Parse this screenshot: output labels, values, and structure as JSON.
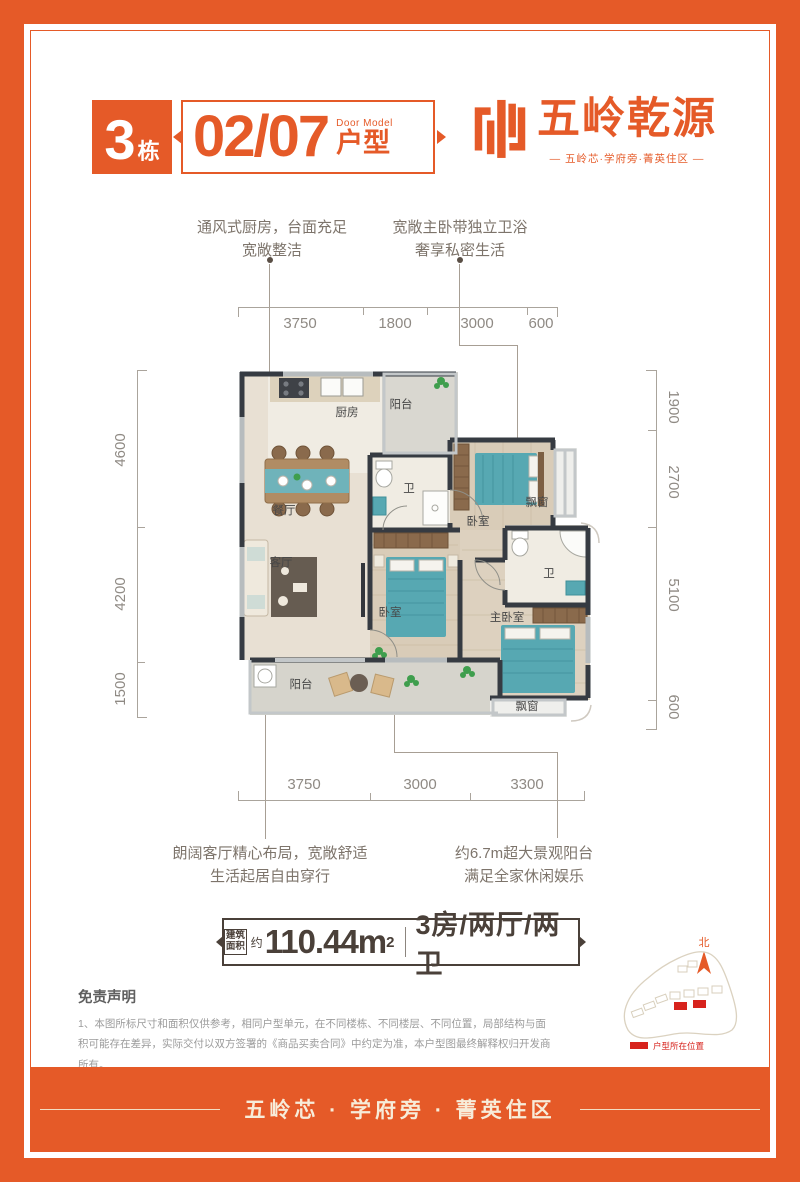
{
  "colors": {
    "accent": "#e55a28",
    "legend_red": "#d7231d"
  },
  "header": {
    "building_num": "3",
    "building_suffix": "栋",
    "unit_code": "02/07",
    "door_model_en": "Door Model",
    "door_model_cn": "户型",
    "brand_name": "五岭乾源",
    "brand_tagline": "— 五岭芯·学府旁·菁英住区 —"
  },
  "callouts": {
    "kitchen": {
      "line1": "通风式厨房，台面充足",
      "line2": "宽敞整洁"
    },
    "master": {
      "line1": "宽敞主卧带独立卫浴",
      "line2": "奢享私密生活"
    },
    "living": {
      "line1": "朗阔客厅精心布局，宽敞舒适",
      "line2": "生活起居自由穿行"
    },
    "balcony": {
      "line1": "约6.7m超大景观阳台",
      "line2": "满足全家休闲娱乐"
    }
  },
  "dimensions": {
    "top": [
      "3750",
      "1800",
      "3000",
      "600"
    ],
    "bottom": [
      "3750",
      "3000",
      "3300"
    ],
    "left": [
      "4600",
      "4200",
      "1500"
    ],
    "right": [
      "1900",
      "2700",
      "5100",
      "600"
    ]
  },
  "rooms": {
    "kitchen": "厨房",
    "balcony_top": "阳台",
    "bath_top": "卫",
    "bedroom_top": "卧室",
    "bay_right": "飘窗",
    "dining": "餐厅",
    "living": "客厅",
    "bedroom_mid": "卧室",
    "master": "主卧室",
    "bath_master": "卫",
    "balcony_bottom": "阳台",
    "bay_bottom": "飘窗"
  },
  "area": {
    "label": "建筑面积",
    "approx": "约",
    "value": "110.44m",
    "sup": "2",
    "layout": "3房/两厅/两卫"
  },
  "disclaimer": {
    "title": "免责声明",
    "line1": "1、本图所标尺寸和面积仅供参考，相同户型单元，在不同楼栋、不同楼层、不同位置，局部结构与面积可能存在差异，实际交付以双方签署的《商品买卖合同》中约定为准，本户型图最终解释权归开发商所有。",
    "line2": "2、本户型图制作时间2022年9月，如有更改恕不另行通知，敬请关注最新资料。 3、项目备案名：瑞亨居，推广名：五岭乾源。"
  },
  "siteplan": {
    "north": "北",
    "legend": "户型所在位置"
  },
  "footer": {
    "tagline": "五岭芯 · 学府旁 · 菁英住区"
  }
}
